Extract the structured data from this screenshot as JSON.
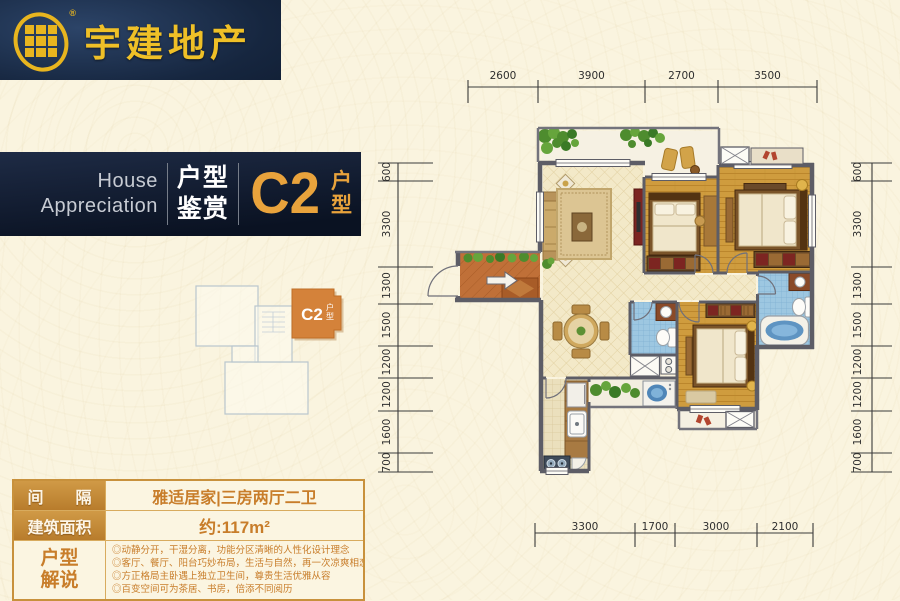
{
  "logo": {
    "company_name": "宇建地产",
    "registered_mark": "®",
    "gold": "#e8b51f",
    "navy": "#16263f"
  },
  "banner": {
    "english_line1": "House",
    "english_line2": "Appreciation",
    "chinese_word_top": "户型",
    "chinese_word_bottom": "鉴赏",
    "unit_code": "C2",
    "unit_label_top": "户",
    "unit_label_bottom": "型",
    "accent": "#e9a33c",
    "background": "#0f1a2e"
  },
  "keyplan": {
    "unit_code": "C2",
    "unit_label_top": "户",
    "unit_label_bottom": "型",
    "highlight_color": "#d4823a"
  },
  "info_table": {
    "row1_label": "间　　隔",
    "row1_value": "雅适居家|三房两厅二卫",
    "row2_label": "建筑面积",
    "row2_value": "约:117m²",
    "row3_label_line1": "户型",
    "row3_label_line2": "解说",
    "row3_bullets": [
      "◎动静分开，干湿分离，功能分区清晰的人性化设计理念",
      "◎客厅、餐厅、阳台巧妙布局，生活与自然，再一次凉爽相恋",
      "◎方正格局主卧遇上独立卫生间，尊贵生活优雅从容",
      "◎百变空间可为茶居、书房，倍添不同阅历"
    ],
    "accent": "#c8913c",
    "text_orange": "#c87d2a"
  },
  "floorplan": {
    "dimensions": {
      "top": {
        "orient": "h",
        "line": 87,
        "tickA": 80,
        "tickB": 103,
        "label": 79,
        "ticks": [
          468,
          538,
          645,
          718,
          817
        ],
        "values": [
          "2600",
          "3900",
          "2700",
          "3500"
        ]
      },
      "bottom": {
        "orient": "h",
        "line": 533,
        "tickA": 523,
        "tickB": 547,
        "label": 530,
        "ticks": [
          535,
          635,
          675,
          757,
          813
        ],
        "values": [
          "3300",
          "1700",
          "3000",
          "2100"
        ]
      },
      "left": {
        "orient": "v",
        "line": 398,
        "tickA": 378,
        "tickB": 433,
        "label": 390,
        "ticks": [
          163,
          181,
          267,
          304,
          346,
          378,
          411,
          453,
          472
        ],
        "values": [
          "600",
          "3300",
          "1300",
          "1500",
          "1200",
          "1200",
          "1600",
          "700"
        ]
      },
      "right": {
        "orient": "v",
        "line": 872,
        "tickA": 851,
        "tickB": 892,
        "label": 861,
        "ticks": [
          163,
          181,
          267,
          304,
          346,
          378,
          411,
          453,
          472
        ],
        "values": [
          "600",
          "3300",
          "1300",
          "1500",
          "1200",
          "1200",
          "1600",
          "700"
        ]
      }
    }
  }
}
